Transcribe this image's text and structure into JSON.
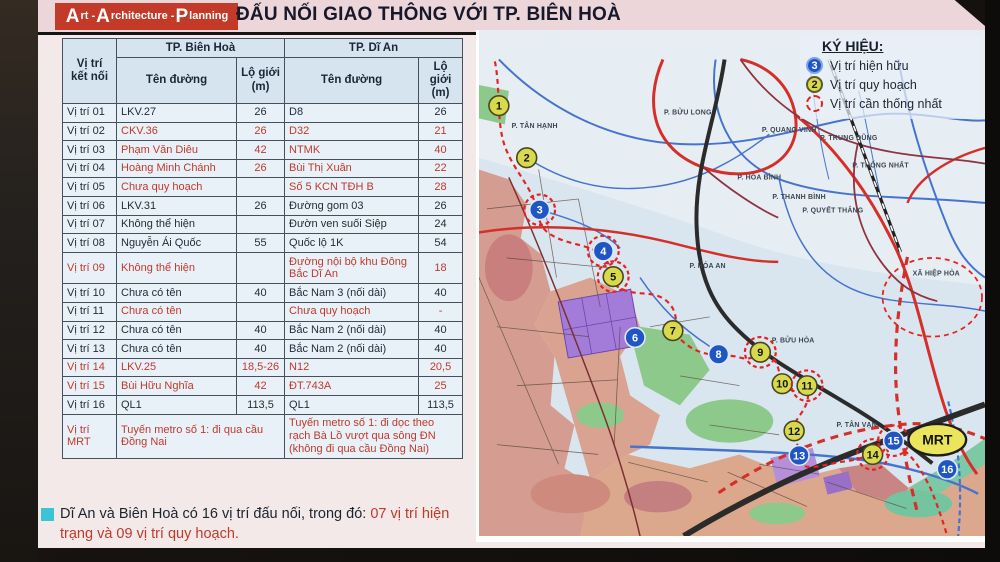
{
  "header": {
    "logo": {
      "parts": [
        {
          "cap": "A",
          "rest": "rt - "
        },
        {
          "cap": "A",
          "rest": "rchitecture - "
        },
        {
          "cap": "P",
          "rest": "lanning"
        }
      ]
    },
    "title": "ĐẤU NỐI GIAO THÔNG VỚI TP. BIÊN HOÀ"
  },
  "table": {
    "corner_header": "Vị trí kết nối",
    "group_headers": [
      "TP. Biên Hoà",
      "TP. Dĩ An"
    ],
    "sub_headers": [
      "Tên đường",
      "Lộ giới (m)",
      "Tên đường",
      "Lộ giới (m)"
    ],
    "rows": [
      {
        "label": "Vị trí 01",
        "bh_name": "LKV.27",
        "bh_width": "26",
        "da_name": "D8",
        "da_width": "26",
        "red": false,
        "label_red": false
      },
      {
        "label": "Vị trí 02",
        "bh_name": "CKV.36",
        "bh_width": "26",
        "da_name": "D32",
        "da_width": "21",
        "red": true,
        "label_red": false
      },
      {
        "label": "Vị trí 03",
        "bh_name": "Phạm Văn Diêu",
        "bh_width": "42",
        "da_name": "NTMK",
        "da_width": "40",
        "red": true,
        "label_red": false
      },
      {
        "label": "Vị trí 04",
        "bh_name": "Hoàng Minh Chánh",
        "bh_width": "26",
        "da_name": "Bùi Thị Xuân",
        "da_width": "22",
        "red": true,
        "label_red": false
      },
      {
        "label": "Vị trí 05",
        "bh_name": "Chưa quy hoạch",
        "bh_width": "",
        "da_name": "Số 5 KCN TĐH B",
        "da_width": "28",
        "red": true,
        "label_red": false
      },
      {
        "label": "Vị trí 06",
        "bh_name": "LKV.31",
        "bh_width": "26",
        "da_name": "Đường gom 03",
        "da_width": "26",
        "red": false,
        "label_red": false
      },
      {
        "label": "Vị trí 07",
        "bh_name": "Không thể hiện",
        "bh_width": "",
        "da_name": "Đườn ven suối Siệp",
        "da_width": "24",
        "red": false,
        "label_red": false
      },
      {
        "label": "Vị trí 08",
        "bh_name": "Nguyễn Ái Quốc",
        "bh_width": "55",
        "da_name": "Quốc lộ 1K",
        "da_width": "54",
        "red": false,
        "label_red": false
      },
      {
        "label": "Vị trí 09",
        "bh_name": "Không thể hiện",
        "bh_width": "",
        "da_name": "Đường nội bộ khu Đông Bắc Dĩ An",
        "da_width": "18",
        "red": true,
        "label_red": true
      },
      {
        "label": "Vị trí 10",
        "bh_name": "Chưa có tên",
        "bh_width": "40",
        "da_name": "Bắc Nam 3 (nối dài)",
        "da_width": "40",
        "red": false,
        "label_red": false
      },
      {
        "label": "Vị trí 11",
        "bh_name": "Chưa có tên",
        "bh_width": "",
        "da_name": "Chưa quy hoạch",
        "da_width": "-",
        "red": true,
        "label_red": false
      },
      {
        "label": "Vị trí 12",
        "bh_name": "Chưa có tên",
        "bh_width": "40",
        "da_name": "Bắc Nam 2 (nối dài)",
        "da_width": "40",
        "red": false,
        "label_red": false
      },
      {
        "label": "Vị trí 13",
        "bh_name": "Chưa có tên",
        "bh_width": "40",
        "da_name": "Bắc Nam 2 (nối dài)",
        "da_width": "40",
        "red": false,
        "label_red": false
      },
      {
        "label": "Vị trí 14",
        "bh_name": "LKV.25",
        "bh_width": "18,5-26",
        "da_name": "N12",
        "da_width": "20,5",
        "red": true,
        "label_red": true
      },
      {
        "label": "Vị trí 15",
        "bh_name": "Bùi Hữu Nghĩa",
        "bh_width": "42",
        "da_name": "ĐT.743A",
        "da_width": "25",
        "red": true,
        "label_red": true
      },
      {
        "label": "Vị trí 16",
        "bh_name": "QL1",
        "bh_width": "113,5",
        "da_name": "QL1",
        "da_width": "113,5",
        "red": false,
        "label_red": false
      }
    ],
    "mrt_row": {
      "label": "Vị trí MRT",
      "bh": "Tuyến metro số 1: đi qua cầu Đồng Nai",
      "da": "Tuyến metro số 1: đi dọc theo rạch Bà Lồ vượt qua sông ĐN (không đi qua cầu Đồng Nai)"
    }
  },
  "footer_note": {
    "black": "Dĩ An và Biên Hoà có 16 vị trí đấu nối, trong đó: ",
    "red": "07 vị trí hiện trạng và 09 vị trí quy hoạch."
  },
  "legend": {
    "title": "KÝ HIỆU:",
    "items": [
      {
        "symbol": "existing",
        "number": "3",
        "label": "Vị trí hiện hữu"
      },
      {
        "symbol": "planned",
        "number": "2",
        "label": "Vị trí quy hoạch"
      },
      {
        "symbol": "unify",
        "number": "",
        "label": "Vị trí cần thống nhất"
      }
    ]
  },
  "map": {
    "markers": [
      {
        "n": "1",
        "x": 20,
        "y": 77,
        "type": "planned",
        "ring": false
      },
      {
        "n": "2",
        "x": 48,
        "y": 130,
        "type": "planned",
        "ring": false
      },
      {
        "n": "3",
        "x": 61,
        "y": 183,
        "type": "existing",
        "ring": true
      },
      {
        "n": "4",
        "x": 125,
        "y": 225,
        "type": "existing",
        "ring": true
      },
      {
        "n": "5",
        "x": 135,
        "y": 251,
        "type": "planned",
        "ring": true
      },
      {
        "n": "6",
        "x": 157,
        "y": 313,
        "type": "existing",
        "ring": false
      },
      {
        "n": "7",
        "x": 195,
        "y": 306,
        "type": "planned",
        "ring": false
      },
      {
        "n": "8",
        "x": 241,
        "y": 330,
        "type": "existing",
        "ring": false
      },
      {
        "n": "9",
        "x": 283,
        "y": 328,
        "type": "planned",
        "ring": true
      },
      {
        "n": "10",
        "x": 305,
        "y": 360,
        "type": "planned",
        "ring": false
      },
      {
        "n": "11",
        "x": 330,
        "y": 362,
        "type": "planned",
        "ring": true
      },
      {
        "n": "12",
        "x": 317,
        "y": 408,
        "type": "planned",
        "ring": false
      },
      {
        "n": "13",
        "x": 322,
        "y": 433,
        "type": "existing",
        "ring": false
      },
      {
        "n": "14",
        "x": 396,
        "y": 432,
        "type": "planned",
        "ring": true
      },
      {
        "n": "15",
        "x": 417,
        "y": 418,
        "type": "existing",
        "ring": true
      },
      {
        "n": "16",
        "x": 471,
        "y": 447,
        "type": "existing",
        "ring": false
      }
    ],
    "mrt": {
      "label": "MRT",
      "x": 461,
      "y": 417
    },
    "wards": [
      {
        "t": "P. TÂN HẠNH",
        "x": 56,
        "y": 100
      },
      {
        "t": "P. BỬU LONG",
        "x": 210,
        "y": 86
      },
      {
        "t": "P. QUANG VINH",
        "x": 312,
        "y": 104
      },
      {
        "t": "P. TRUNG DŨNG",
        "x": 372,
        "y": 112
      },
      {
        "t": "P. HÒA BÌNH",
        "x": 282,
        "y": 152
      },
      {
        "t": "P. THANH BÌNH",
        "x": 322,
        "y": 172
      },
      {
        "t": "P. THỐNG NHẤT",
        "x": 404,
        "y": 140
      },
      {
        "t": "P. QUYẾT THẮNG",
        "x": 356,
        "y": 186
      },
      {
        "t": "XÃ HIỆP HÒA",
        "x": 460,
        "y": 250
      },
      {
        "t": "P. HÓA AN",
        "x": 230,
        "y": 242
      },
      {
        "t": "P. BỬU HÒA",
        "x": 316,
        "y": 318
      },
      {
        "t": "P. TÂN VẠN",
        "x": 380,
        "y": 404
      }
    ]
  },
  "colors": {
    "logo_red": "#c43a28",
    "accent_red": "#c0392b",
    "existing_blue": "#1f55c4",
    "planned_yellow": "#d9d94e",
    "unify_ring": "#e42222",
    "bullet_cyan": "#3bc4d6"
  }
}
